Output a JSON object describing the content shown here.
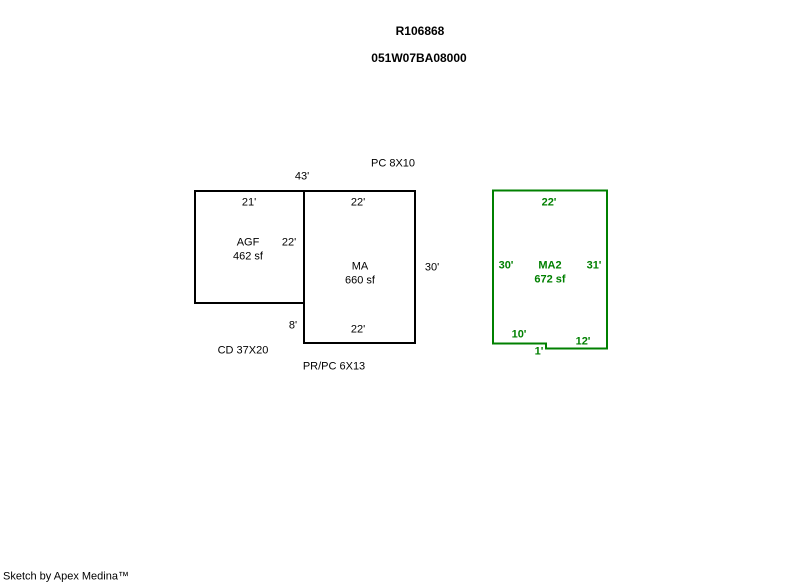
{
  "page": {
    "title_line1": "R106868",
    "title_line2": "051W07BA08000",
    "footer": "Sketch by Apex Medina™"
  },
  "colors": {
    "background": "#ffffff",
    "main_outline": "#000000",
    "addition_outline": "#008000",
    "text": "#000000"
  },
  "sketch": {
    "annotations": {
      "pc": "PC 8X10",
      "overall_top_width": "43'",
      "cd": "CD 37X20",
      "prpc": "PR/PC 6X13"
    },
    "agf": {
      "name": "AGF",
      "area": "462 sf",
      "top": "21'",
      "right": "22'"
    },
    "ma": {
      "name": "MA",
      "area": "660 sf",
      "top": "22'",
      "right": "30'",
      "bottom": "22'",
      "left_offset": "8'"
    },
    "ma2": {
      "name": "MA2",
      "area": "672 sf",
      "top": "22'",
      "left": "30'",
      "right": "31'",
      "bottom_left": "10'",
      "bottom_right": "12'",
      "step": "1'"
    }
  }
}
